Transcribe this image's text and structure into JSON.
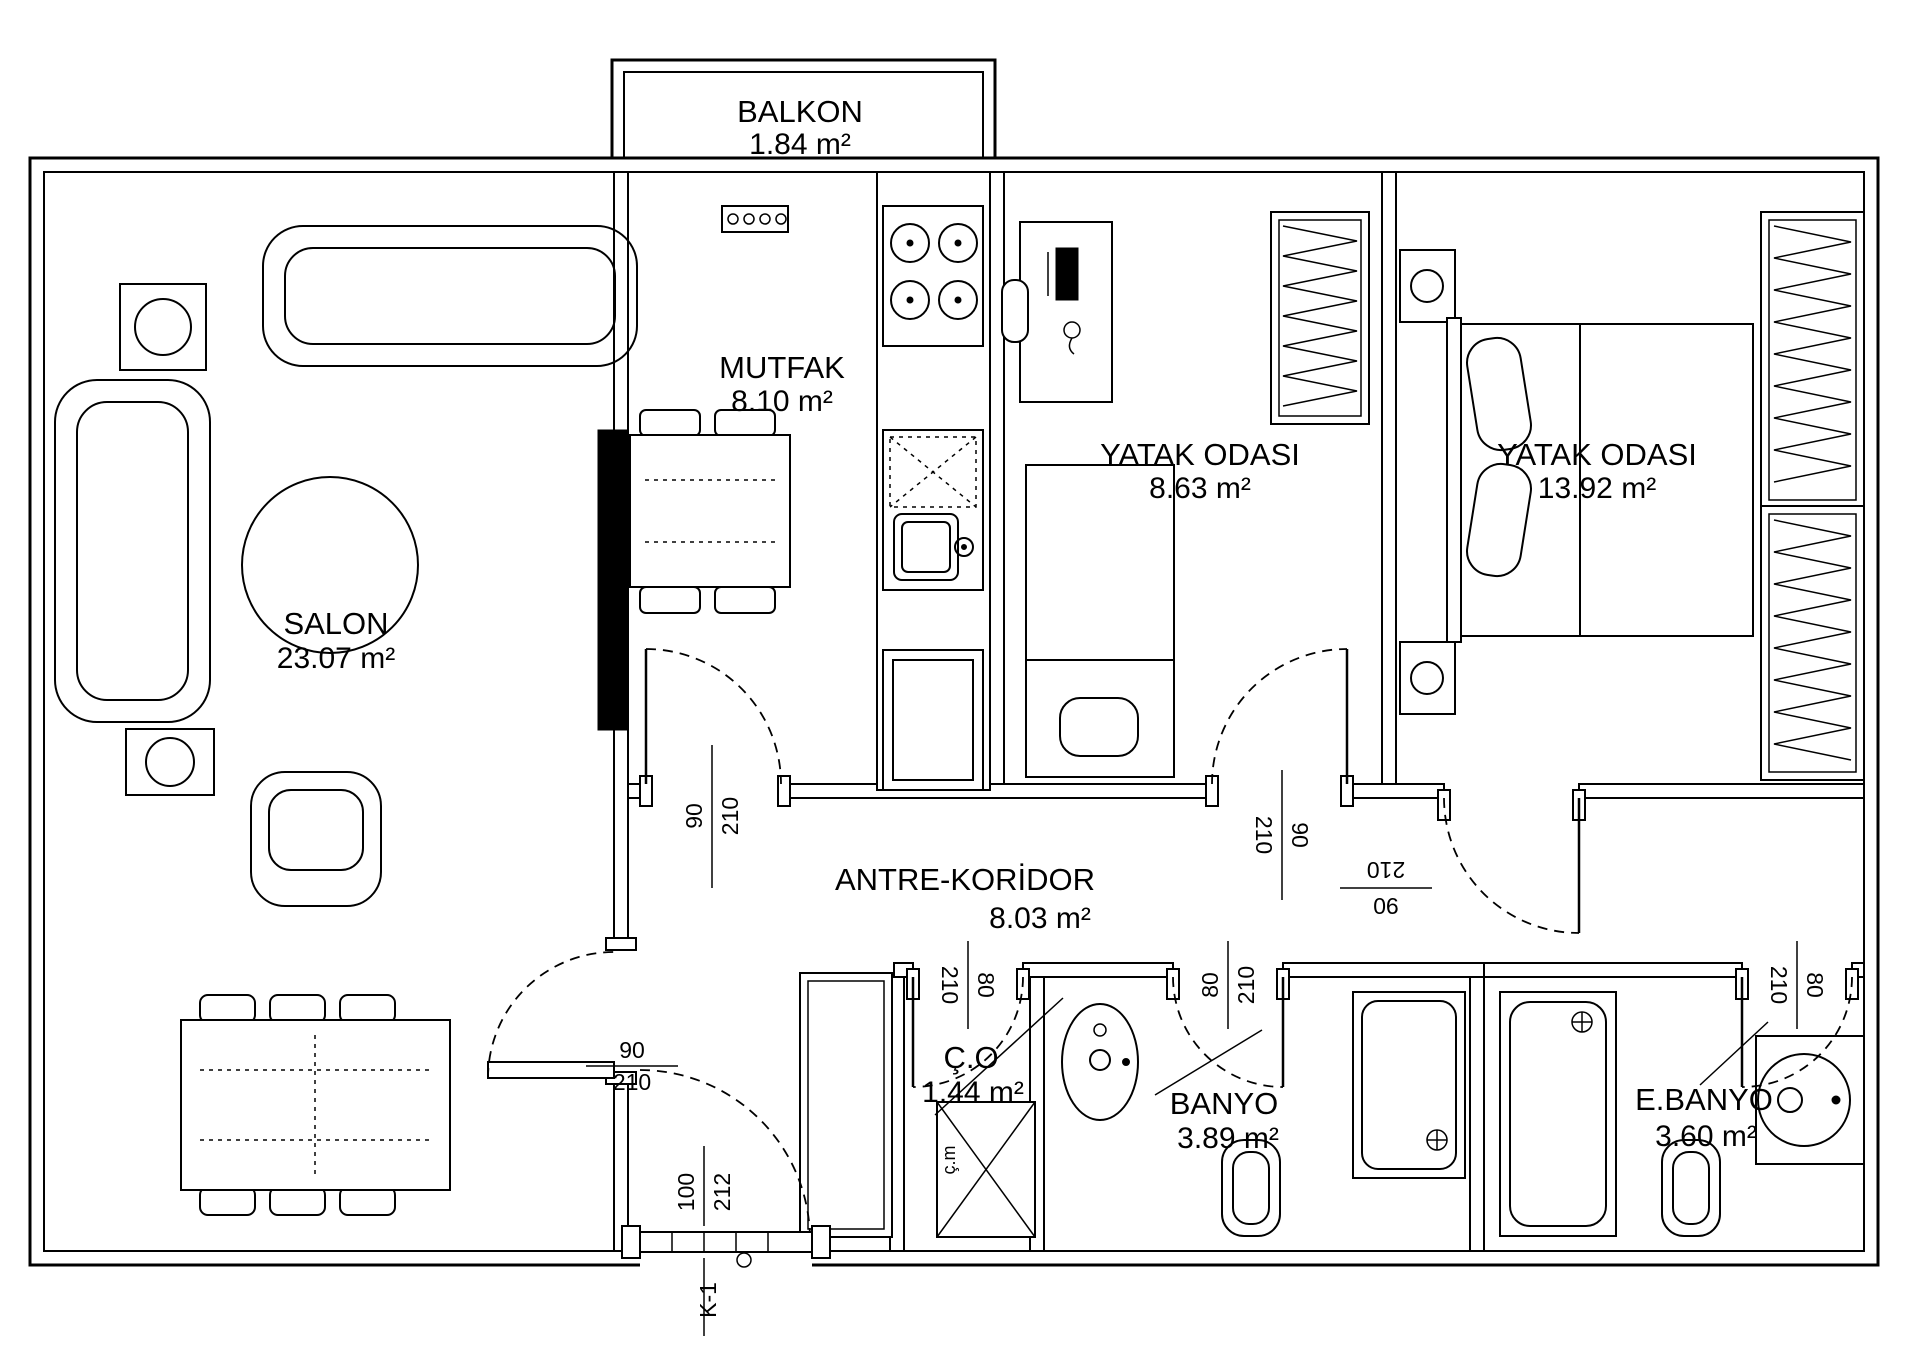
{
  "plan": {
    "rooms": {
      "balkon": {
        "name": "BALKON",
        "area": "1.84  m²"
      },
      "salon": {
        "name": "SALON",
        "area": "23.07 m²"
      },
      "mutfak": {
        "name": "MUTFAK",
        "area": "8.10 m²"
      },
      "yatak1": {
        "name": "YATAK ODASI",
        "area": "8.63 m²"
      },
      "yatak2": {
        "name": "YATAK ODASI",
        "area": "13.92 m²"
      },
      "antre": {
        "name": "ANTRE-KORİDOR",
        "area": "8.03 m²"
      },
      "co": {
        "name": "Ç.O",
        "area": "1.44 m²"
      },
      "banyo1": {
        "name": "BANYO",
        "area": "3.89 m²"
      },
      "banyo2": {
        "name": "E.BANYO",
        "area": "3.60 m²"
      }
    },
    "dims": {
      "kitchen_door": {
        "w": "90",
        "h": "210"
      },
      "bed1_door": {
        "w": "90",
        "h": "210"
      },
      "bed2_door": {
        "w": "90",
        "h": "210"
      },
      "salon_door": {
        "w": "90",
        "h": "210"
      },
      "co_door": {
        "w": "80",
        "h": "210"
      },
      "banyo1_door": {
        "w": "80",
        "h": "210"
      },
      "banyo2_door": {
        "w": "80",
        "h": "210"
      },
      "entry_door": {
        "w": "100",
        "h": "212"
      }
    },
    "labels": {
      "entry_door_code": "K-1",
      "washing_machine": "ç.m"
    }
  }
}
